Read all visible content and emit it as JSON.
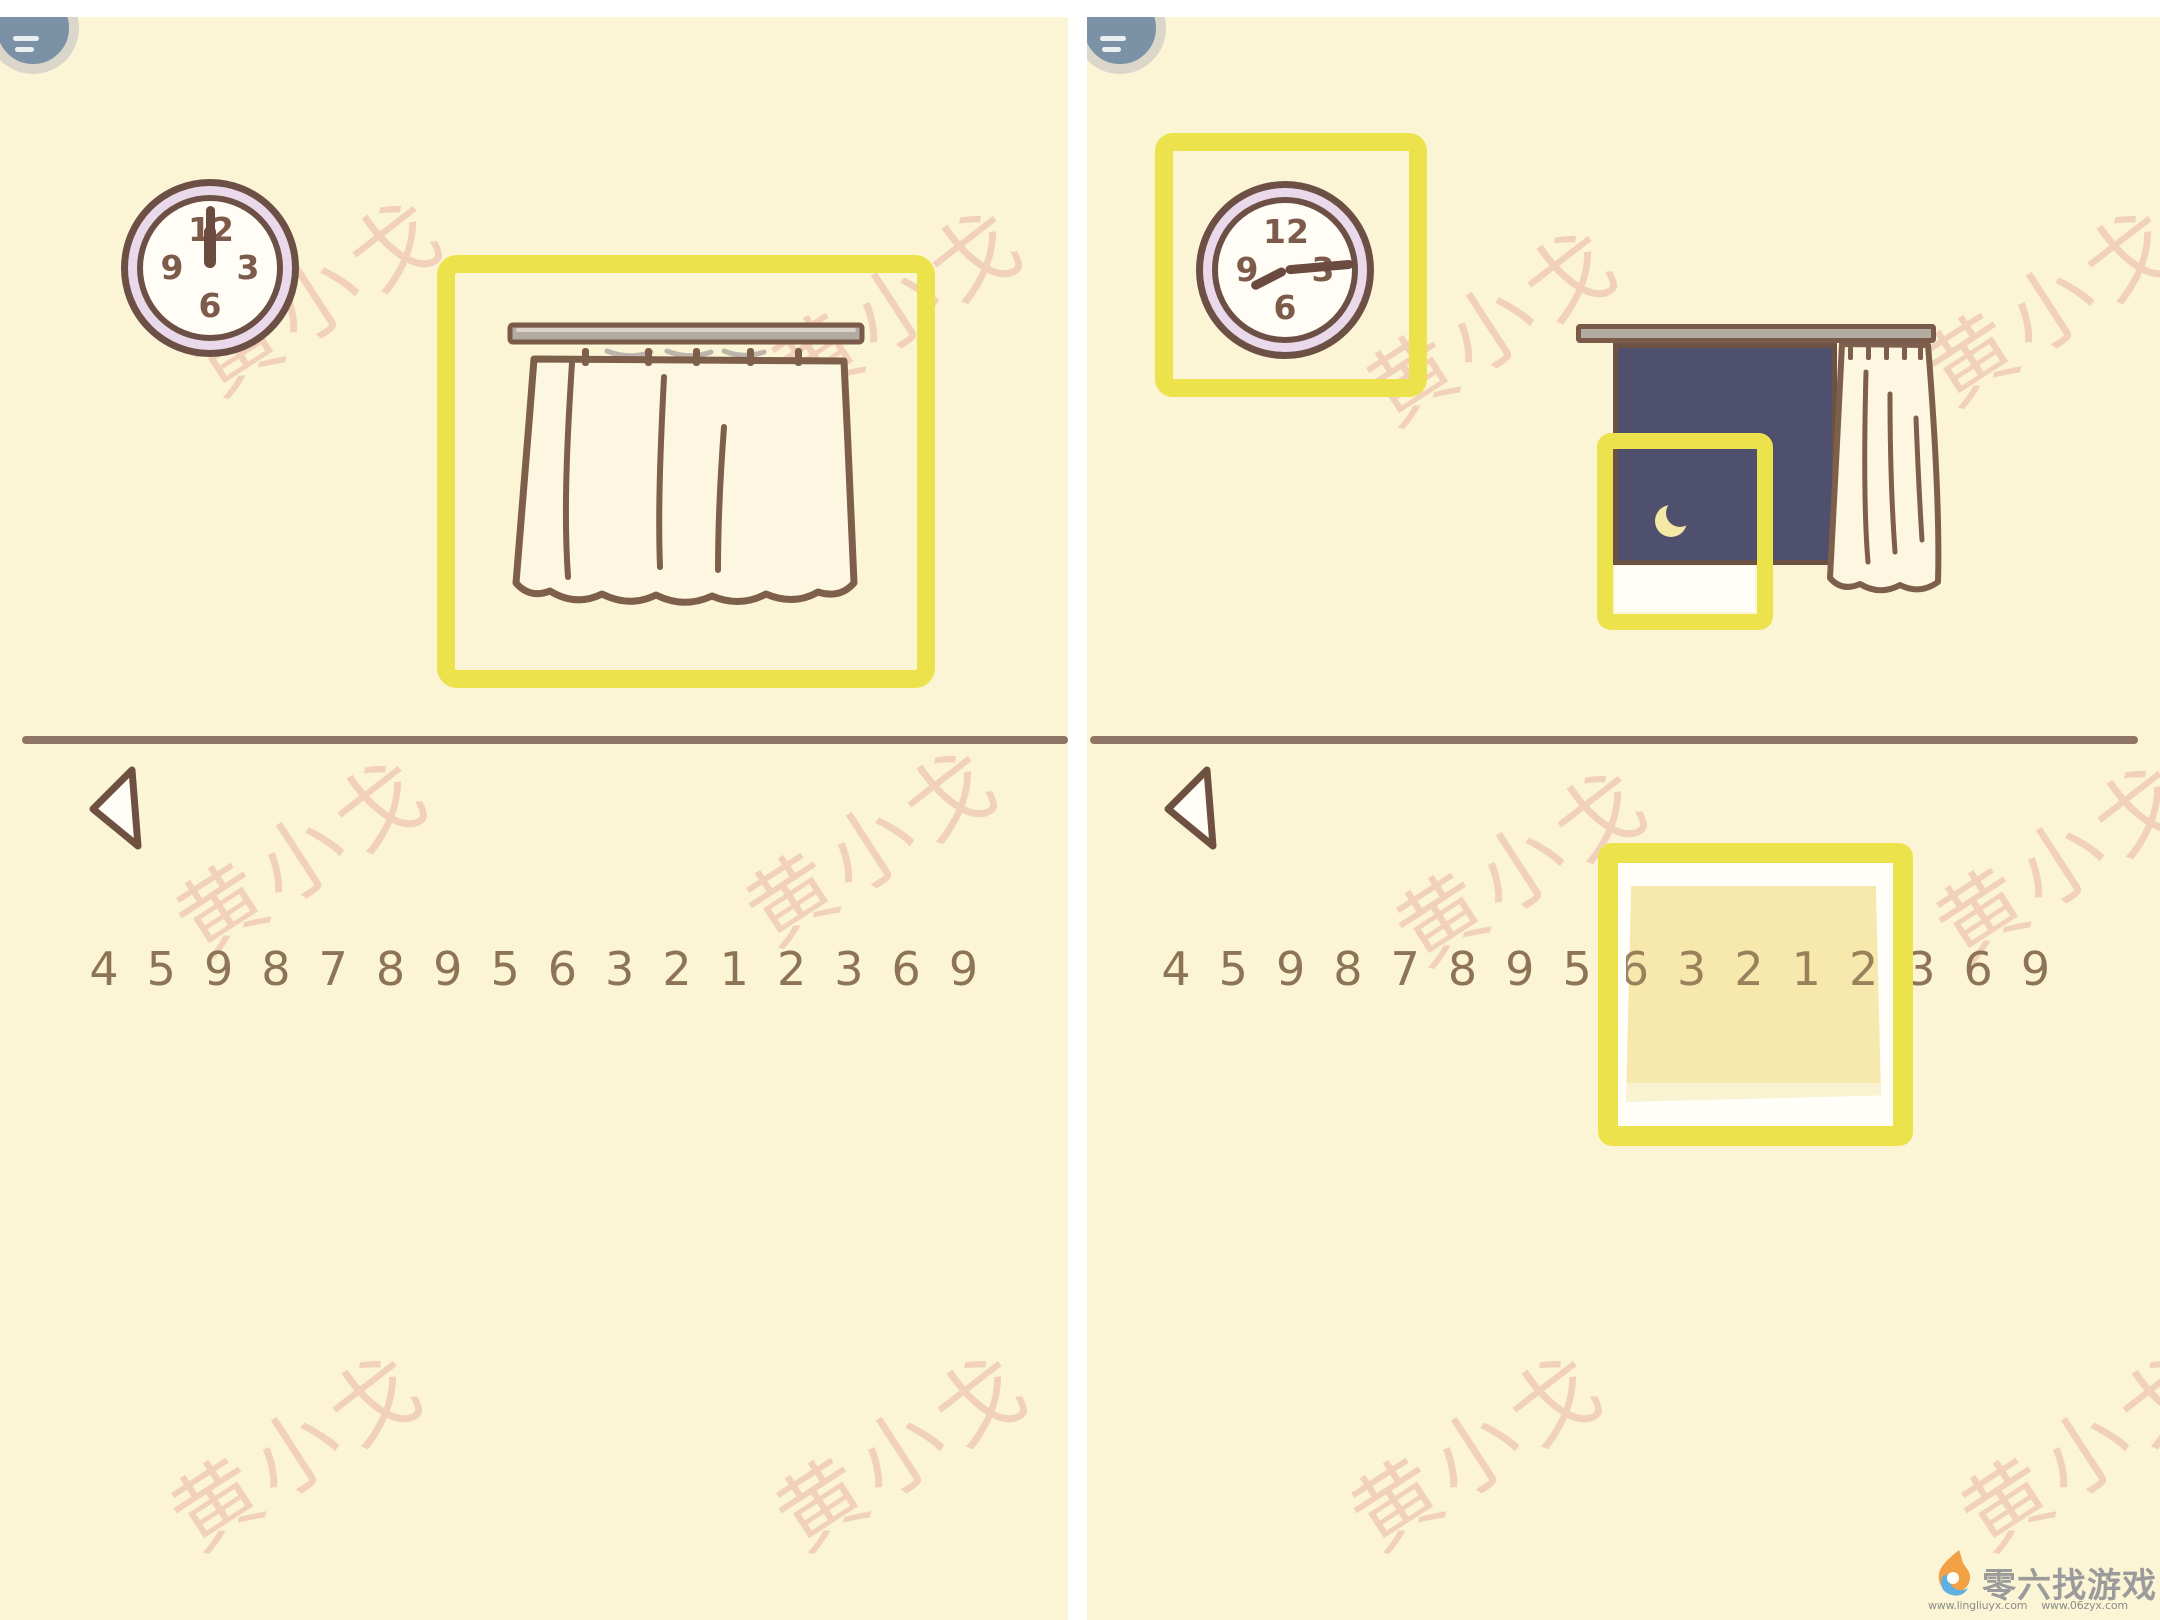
{
  "panels": {
    "left": {
      "label": "scene with curtain closed",
      "clock": {
        "numerals": [
          "12",
          "3",
          "6",
          "9"
        ],
        "hands": [
          {
            "deg": 0,
            "len": 62,
            "w": 9
          },
          {
            "deg": 0,
            "len": 42,
            "w": 12
          }
        ],
        "reading": "12:00"
      },
      "digits": [
        "4",
        "5",
        "9",
        "8",
        "7",
        "8",
        "9",
        "5",
        "6",
        "3",
        "2",
        "1",
        "2",
        "3",
        "6",
        "9"
      ]
    },
    "right": {
      "label": "scene with curtain open showing night window",
      "clock": {
        "numerals": [
          "12",
          "3",
          "6",
          "9"
        ],
        "hands": [
          {
            "deg": 85,
            "len": 68,
            "w": 9
          },
          {
            "deg": 243,
            "len": 38,
            "w": 9
          }
        ],
        "reading": "about 3:00"
      },
      "digits": [
        "4",
        "5",
        "9",
        "8",
        "7",
        "8",
        "9",
        "5",
        "6",
        "3",
        "2",
        "1",
        "2",
        "3",
        "6",
        "9"
      ],
      "note_highlighted_digits": "6 3 2 1 2"
    }
  },
  "watermark": {
    "text": "黄小戈",
    "instances": [
      [
        315,
        290
      ],
      [
        895,
        300
      ],
      [
        300,
        850
      ],
      [
        870,
        840
      ],
      [
        295,
        1445
      ],
      [
        900,
        1445
      ],
      [
        1490,
        320
      ],
      [
        2050,
        300
      ],
      [
        1520,
        860
      ],
      [
        2060,
        855
      ],
      [
        1475,
        1445
      ],
      [
        2085,
        1445
      ]
    ]
  },
  "footer": {
    "brand": "零六找游戏",
    "urls": [
      "www.lingliuyx.com",
      "www.06zyx.com"
    ]
  },
  "colors": {
    "panel_bg": "#fbf5d5",
    "highlight_box": "#ece24b",
    "outline_brown": "#7d5f4b",
    "divider": "#8e7565",
    "digits": "#8e7457",
    "night_window": "#4f4f6e",
    "clock_ring": "#e9d9ea",
    "moon": "#f4e8a4",
    "sticky_note": "#f6e5a0",
    "watermark_pink": "#e6968e"
  }
}
